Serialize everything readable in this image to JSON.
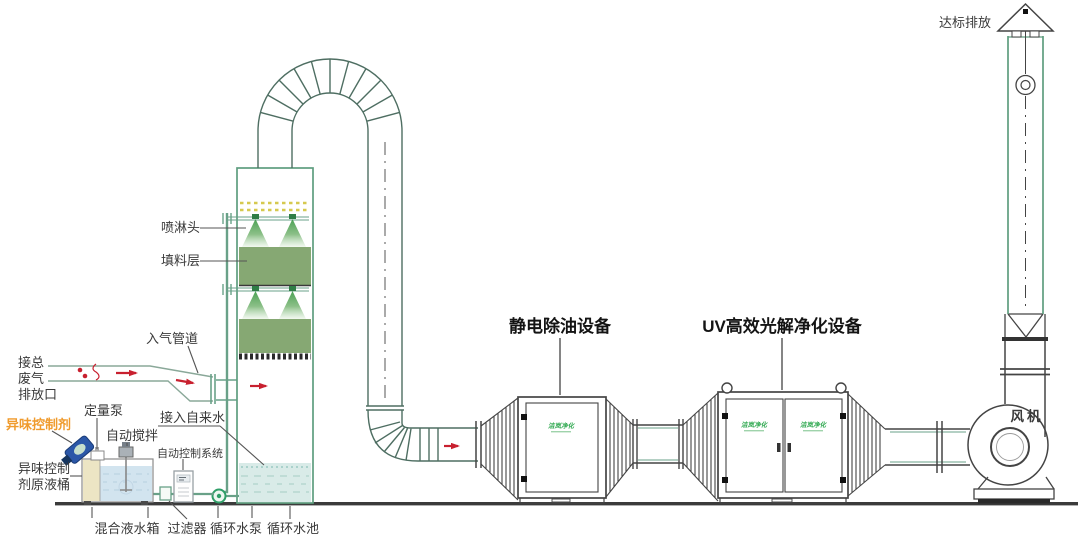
{
  "diagram_title": "废气处理工艺流程图",
  "colors": {
    "tower_green": "#5f9e7f",
    "duct_green": "#4e6e62",
    "pipe_green": "#69a188",
    "packing_green": "#86a873",
    "spray_green": "#3f9b4a",
    "demister_yellow": "#d6c94f",
    "water_blue": "#d9ebe8",
    "tank_water": "#d2e4ef",
    "red_arrow": "#c8202f",
    "orange_label": "#f09b2d",
    "brand_green": "#2ea84f",
    "equipment_gray": "#444444"
  },
  "brand": {
    "logo": "洁岚净化"
  },
  "labels": {
    "emission": "达标排放",
    "fan": "风机",
    "box1_title": "静电除油设备",
    "box2_title": "UV高效光解净化设备",
    "spray_head": "喷淋头",
    "packing_layer": "填料层",
    "inlet_pipe": "入气管道",
    "tap_water": "接入自来水",
    "waste_inlet_lines": [
      "接总",
      "废气",
      "排放口"
    ],
    "odor_agent": "异味控制剂",
    "dosing_pump": "定量泵",
    "auto_stir": "自动搅拌",
    "auto_control": "自动控制系统",
    "agent_barrel_lines": [
      "异味控制",
      "剂原液桶"
    ],
    "mix_tank": "混合液水箱",
    "filter": "过滤器",
    "circ_pump": "循环水泵",
    "circ_pool": "循环水池"
  }
}
